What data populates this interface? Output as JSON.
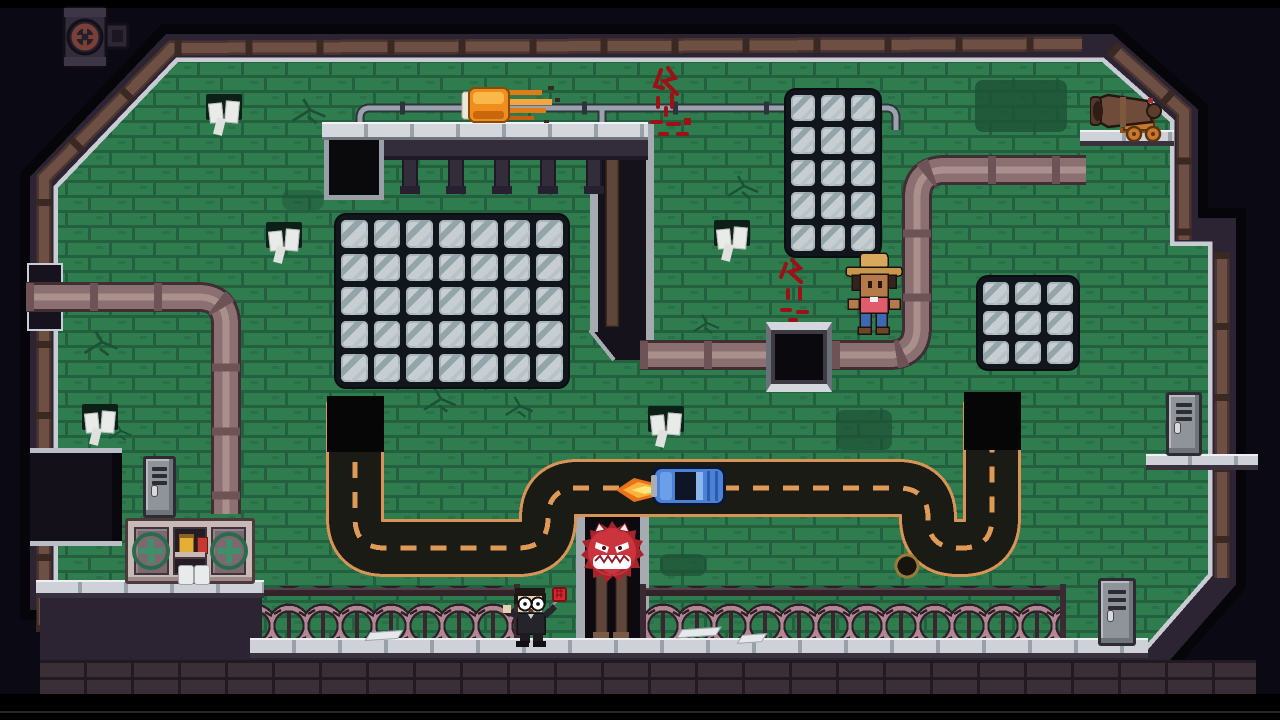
{
  "app": {
    "type": "2d-pixel-platformer-game",
    "view": "level-room-screenshot",
    "visible_text": "none"
  },
  "palette": {
    "deep": "#0b0913",
    "wall": "#2c2433",
    "trim": "#c9ccd3",
    "brick": "#2f7c4f",
    "brickLine": "#226040",
    "mossDark": "#1d5134",
    "windowBg": "#10161c",
    "glass": "#c6ced2",
    "glassShade": "#93a4aa",
    "pipe": "#8b6f71",
    "pipeDark": "#3f2f33",
    "pipeSheen": "#a9908d",
    "steel": "#9aa3ad",
    "steelDark": "#2e343b",
    "ledge": "#ced2d8",
    "ledgeDark": "#39323e",
    "roadFill": "#1b1b15",
    "roadLine": "#e09a58",
    "wire": "#b28793",
    "wireDark": "#2c1f27",
    "flameOrange": "#ef8d1d",
    "flameYellow": "#ffd23e",
    "flameCore": "#ffe57a",
    "carBlue": "#4b82d8",
    "carDark": "#0c1730",
    "monsterRed": "#cb343d",
    "monsterDark": "#8e1f2c",
    "cannonBrown": "#6f4b39",
    "carriageOrange": "#c8772c",
    "cabinetFrame": "#c9b9b6",
    "doorMauve": "#7c6970",
    "crossGreen": "#2a6b50",
    "lockerGray": "#8f939a",
    "graffitiRed": "#9c1016",
    "skinTan": "#b5794a",
    "skinPale": "#ead0b2",
    "shirtPink": "#e25b6d",
    "jeansBlue": "#3d69b4",
    "hatTan": "#d8a85c",
    "coatBlack": "#26242b",
    "swatterRed": "#d4282f"
  },
  "scene": {
    "windows": [
      {
        "id": "big",
        "cols": 7,
        "rows": 5
      },
      {
        "id": "tall",
        "cols": 3,
        "rows": 5
      },
      {
        "id": "small",
        "cols": 3,
        "rows": 3
      }
    ],
    "entities": [
      {
        "name": "valve-hatch",
        "kind": "prop",
        "desc": "exterior wall hatch with rusty red valve wheel, top-left"
      },
      {
        "name": "fireball",
        "kind": "hazard",
        "desc": "flaming orange object streaking left under ceiling rail"
      },
      {
        "name": "ceiling-rail",
        "kind": "structure",
        "desc": "thin steel pipe rail across upper room"
      },
      {
        "name": "metal-platform",
        "kind": "structure",
        "desc": "stone-top platform with hanging brackets"
      },
      {
        "name": "platform-pit",
        "kind": "opening",
        "desc": "black framed opening at platform left end"
      },
      {
        "name": "glass-window-big",
        "kind": "structure",
        "desc": "7x5 glass-block window"
      },
      {
        "name": "glass-window-tall",
        "kind": "structure",
        "desc": "3x5 glass-block window"
      },
      {
        "name": "glass-window-small",
        "kind": "structure",
        "desc": "3x3 glass-block window"
      },
      {
        "name": "wall-pipe-left",
        "kind": "structure",
        "desc": "mauve pipe entering from left wall, elbow down behind cabinet"
      },
      {
        "name": "wall-pipe-right",
        "kind": "structure",
        "desc": "mauve pipe from divider elbowing up to right wall"
      },
      {
        "name": "wall-hatch",
        "kind": "opening",
        "desc": "black hatch with stone frame over middle pipe"
      },
      {
        "name": "divider-column",
        "kind": "structure",
        "desc": "dark trimmed column between upper rooms"
      },
      {
        "name": "cowboy-character",
        "kind": "character",
        "desc": "jumping; tan cowboy hat, pink shirt, blue jeans"
      },
      {
        "name": "graffiti-red",
        "kind": "decal",
        "count": 2,
        "desc": "red spray scribbles with drips"
      },
      {
        "name": "paper-towels",
        "kind": "decal",
        "count": 5,
        "desc": "white papers tucked in wall slots"
      },
      {
        "name": "cannon",
        "kind": "prop",
        "desc": "bronze cannon on orange wheeled carriage facing left, on ledge"
      },
      {
        "name": "road",
        "kind": "structure",
        "desc": "dark winding road with orange dashed centerline joining two black pits"
      },
      {
        "name": "road-pit-left",
        "kind": "opening"
      },
      {
        "name": "road-pit-right",
        "kind": "opening"
      },
      {
        "name": "blue-car",
        "kind": "vehicle",
        "desc": "top-down blue car with exhaust flame at rear"
      },
      {
        "name": "manhole",
        "kind": "decal",
        "desc": "small round cover at road's lower-right corner"
      },
      {
        "name": "spike-monster",
        "kind": "enemy",
        "desc": "red spiked ball, white horns, angry eyes, toothy grin, rising from shaft"
      },
      {
        "name": "monster-shaft",
        "kind": "structure",
        "desc": "trimmed shaft with wooden posts below road"
      },
      {
        "name": "barbed-wire",
        "kind": "hazard",
        "count": 2,
        "desc": "coiled pink barbed wire rows along bottom"
      },
      {
        "name": "agent-character",
        "kind": "character",
        "desc": "black coat, round white glasses, holding red flyswatter"
      },
      {
        "name": "first-aid-cabinet",
        "kind": "prop",
        "desc": "two green-cross doors; open shelf with yellow jar, red bottle, two paper rolls"
      },
      {
        "name": "locker",
        "kind": "prop",
        "count": 3,
        "desc": "grey vented lockers"
      },
      {
        "name": "dark-passage",
        "kind": "opening",
        "desc": "dark doorway in left wall"
      },
      {
        "name": "stone-ledges",
        "kind": "structure",
        "desc": "light stone ledges along floor and walls"
      }
    ]
  }
}
